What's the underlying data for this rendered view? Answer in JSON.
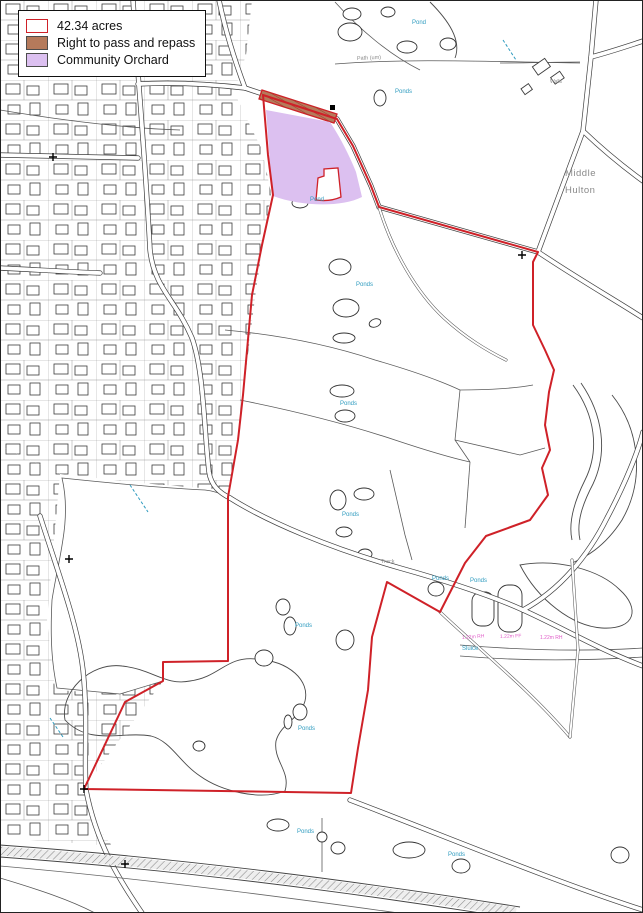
{
  "legend": {
    "items": [
      {
        "label": "42.34 acres",
        "fill": "#ffffff",
        "stroke": "#cf2128"
      },
      {
        "label": "Right to pass and repass",
        "fill": "#b57a5b",
        "stroke": "#4d4d4d"
      },
      {
        "label": "Community Orchard",
        "fill": "#dcc0f0",
        "stroke": "#4d4d4d"
      }
    ]
  },
  "map": {
    "place_labels": {
      "middle": "Middle",
      "hulton": "Hulton",
      "walls": "Walls"
    },
    "path_labels": {
      "path_um": "Path (um)",
      "track": "Track"
    },
    "water_label": "Ponds",
    "water_label_singular": "Pond",
    "sluice_label": "Sluice",
    "boundary_annotations": [
      "1.22m RH",
      "1.22m FF",
      "1.22m RH"
    ],
    "colors": {
      "site_boundary": "#cf2128",
      "community_orchard": "#dcc0f0",
      "right_of_way": "#b57a5b",
      "water_text": "#2e9bbf",
      "annotation_text": "#e05cc8"
    }
  }
}
